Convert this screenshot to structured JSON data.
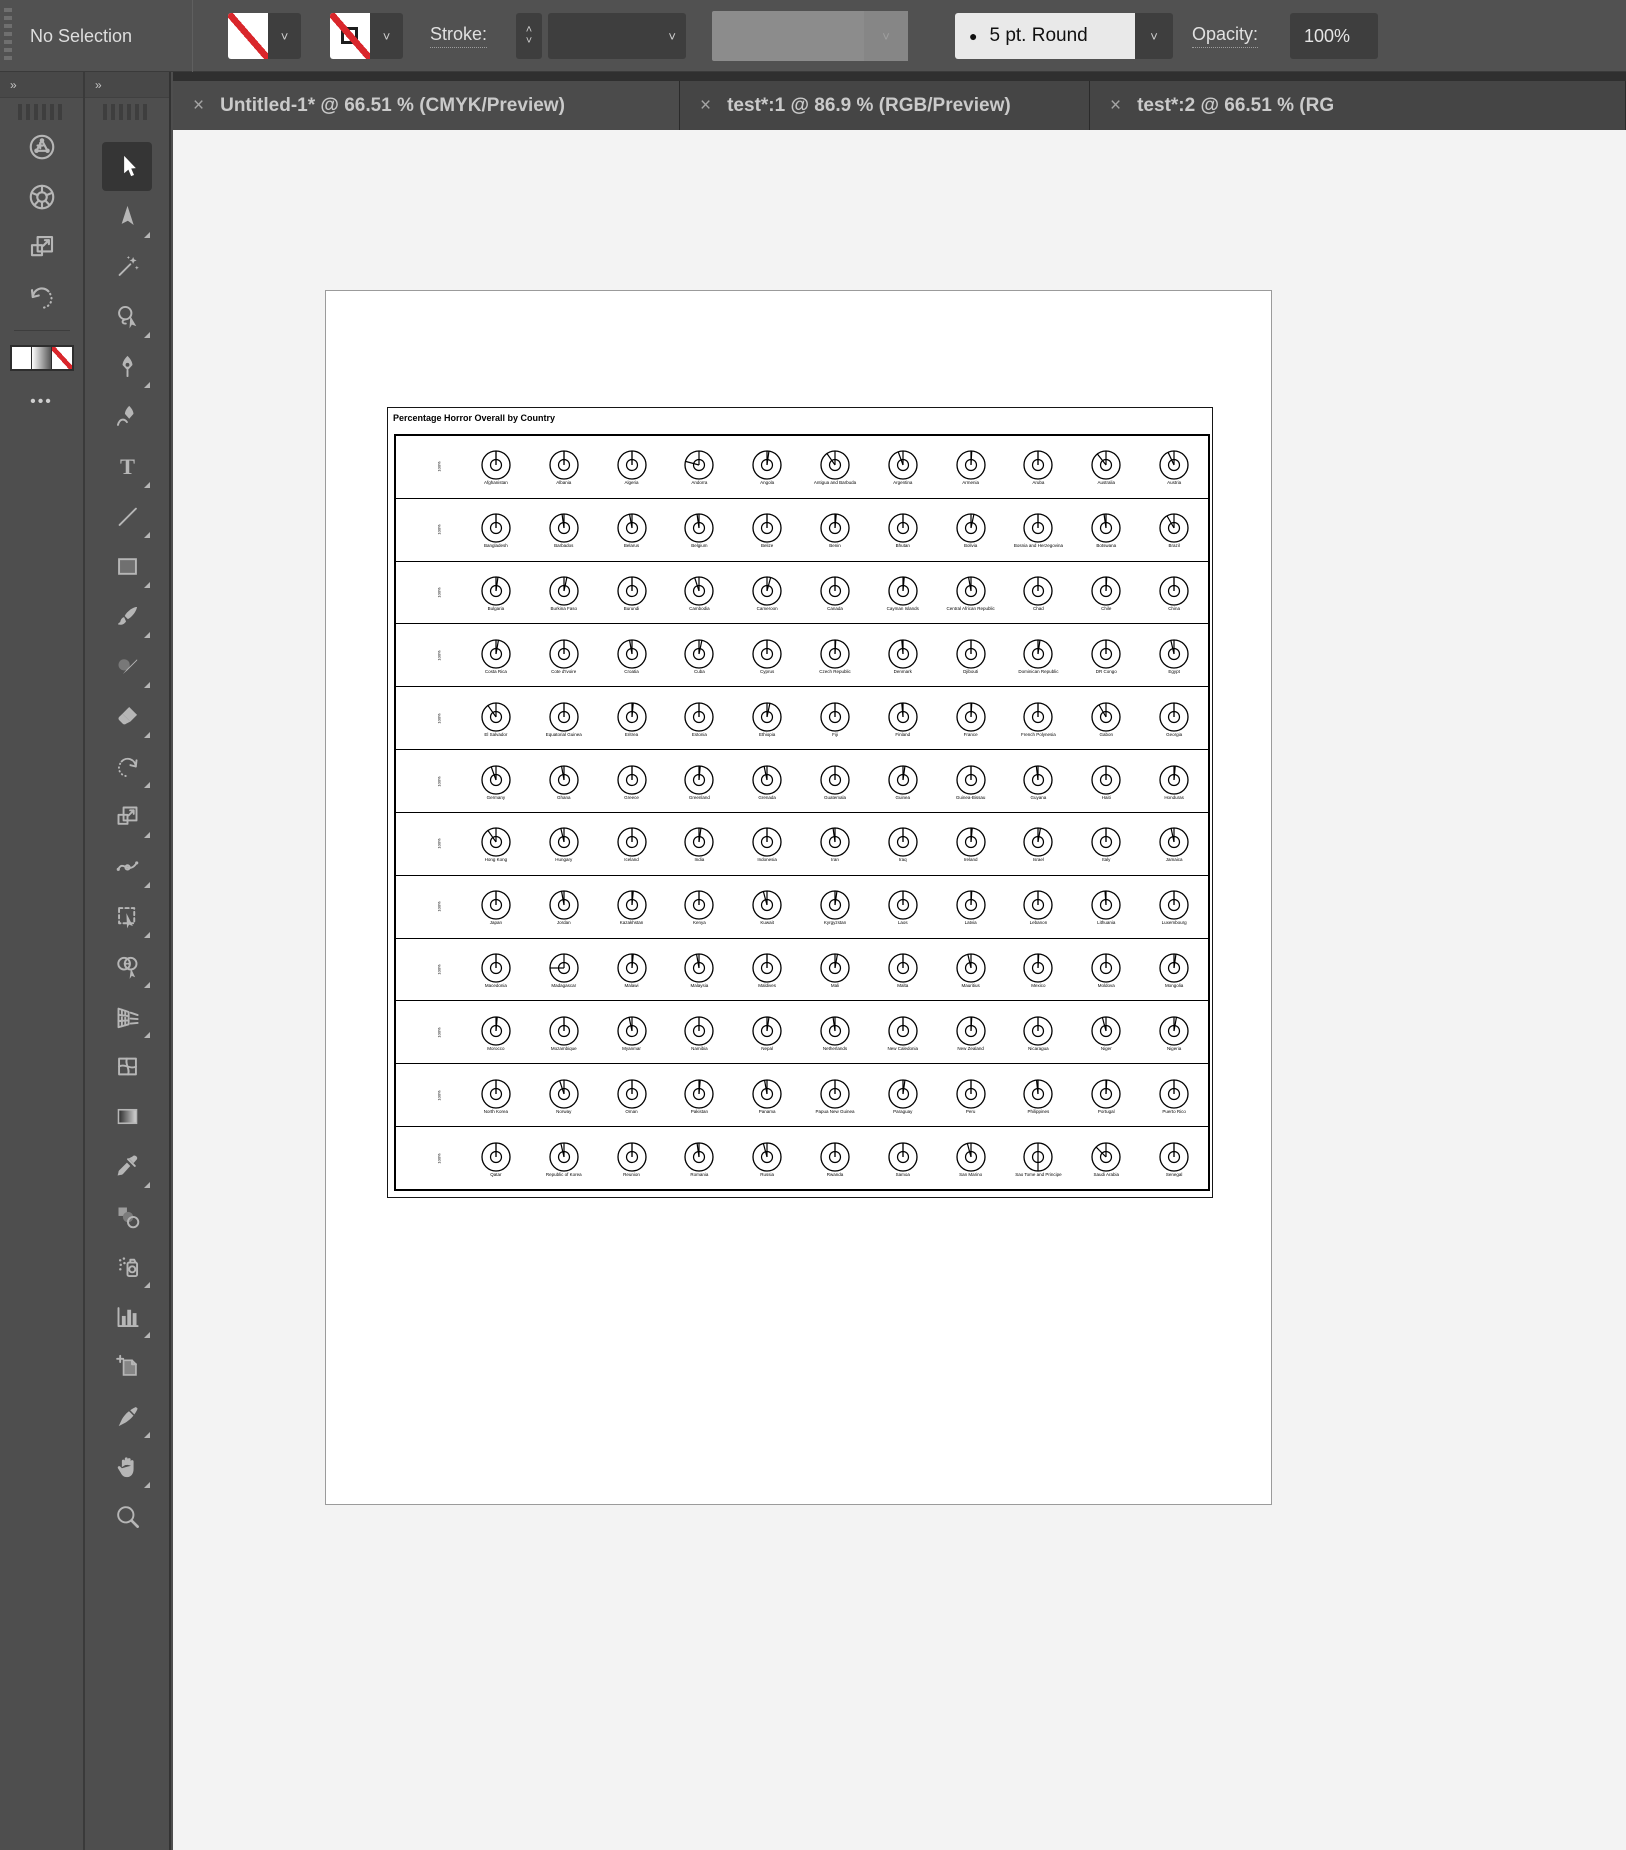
{
  "toolbar": {
    "selection_status": "No Selection",
    "stroke_label": "Stroke:",
    "stroke_width_value": "",
    "brush_bullet": "●",
    "brush_definition": "5 pt. Round",
    "opacity_label": "Opacity:",
    "opacity_value": "100%",
    "fill_swatch": "none-red-slash",
    "stroke_swatch": "none-red-slash"
  },
  "tabs": [
    {
      "close": "×",
      "label": "Untitled-1* @ 66.51 % (CMYK/Preview)"
    },
    {
      "close": "×",
      "label": "test*:1 @ 86.9 % (RGB/Preview)"
    },
    {
      "close": "×",
      "label": "test*:2 @ 66.51 % (RG"
    }
  ],
  "panel_collapse_chevron": "»",
  "dock_icons": [
    {
      "name": "touch-widget-icon"
    },
    {
      "name": "rotate-view-wheel-icon"
    },
    {
      "name": "transform-scale-icon"
    },
    {
      "name": "revert-rotate-icon"
    }
  ],
  "dock_more_label": "•••",
  "tools": [
    {
      "name": "selection",
      "active": true,
      "flyout": false
    },
    {
      "name": "direct-selection",
      "active": false,
      "flyout": true
    },
    {
      "name": "magic-wand",
      "active": false,
      "flyout": false
    },
    {
      "name": "lasso",
      "active": false,
      "flyout": true
    },
    {
      "name": "pen",
      "active": false,
      "flyout": true
    },
    {
      "name": "curvature",
      "active": false,
      "flyout": false
    },
    {
      "name": "type",
      "active": false,
      "flyout": true
    },
    {
      "name": "line-segment",
      "active": false,
      "flyout": true
    },
    {
      "name": "rectangle",
      "active": false,
      "flyout": true
    },
    {
      "name": "paintbrush",
      "active": false,
      "flyout": true
    },
    {
      "name": "shaper",
      "active": false,
      "flyout": true
    },
    {
      "name": "eraser",
      "active": false,
      "flyout": true
    },
    {
      "name": "rotate",
      "active": false,
      "flyout": true
    },
    {
      "name": "scale",
      "active": false,
      "flyout": true
    },
    {
      "name": "width",
      "active": false,
      "flyout": true
    },
    {
      "name": "free-transform",
      "active": false,
      "flyout": true
    },
    {
      "name": "shape-builder",
      "active": false,
      "flyout": true
    },
    {
      "name": "perspective-grid",
      "active": false,
      "flyout": true
    },
    {
      "name": "mesh",
      "active": false,
      "flyout": false
    },
    {
      "name": "gradient",
      "active": false,
      "flyout": false
    },
    {
      "name": "eyedropper",
      "active": false,
      "flyout": true
    },
    {
      "name": "blend",
      "active": false,
      "flyout": false
    },
    {
      "name": "symbol-sprayer",
      "active": false,
      "flyout": true
    },
    {
      "name": "column-graph",
      "active": false,
      "flyout": true
    },
    {
      "name": "artboard",
      "active": false,
      "flyout": false
    },
    {
      "name": "slice",
      "active": false,
      "flyout": true
    },
    {
      "name": "hand",
      "active": false,
      "flyout": true
    },
    {
      "name": "zoom",
      "active": false,
      "flyout": false
    }
  ],
  "chart_data": {
    "type": "pie",
    "variant": "radial-gauge-grid",
    "title": "Percentage Horror Overall by Country",
    "row_axis_label": "100%",
    "layout": {
      "rows": 12,
      "cols": 11,
      "legend": "none",
      "grid": "row-bands"
    },
    "value_encoding": "needle angle, degrees clockwise from 12 o'clock (percent of 360)",
    "rows": [
      {
        "countries": [
          "Afghanistan",
          "Albania",
          "Algeria",
          "Andorra",
          "Angola",
          "Antigua and Barbuda",
          "Argentina",
          "Armenia",
          "Aruba",
          "Australia",
          "Austria"
        ],
        "angles": [
          0,
          0,
          0,
          285,
          8,
          325,
          340,
          3,
          0,
          322,
          335
        ]
      },
      {
        "countries": [
          "Bangladesh",
          "Barbados",
          "Belarus",
          "Belgium",
          "Belize",
          "Benin",
          "Bhutan",
          "Bolivia",
          "Bosnia and Herzegovina",
          "Botswana",
          "Brazil"
        ],
        "angles": [
          0,
          352,
          350,
          352,
          0,
          5,
          0,
          12,
          0,
          352,
          330
        ]
      },
      {
        "countries": [
          "Bulgaria",
          "Burkina Faso",
          "Burundi",
          "Cambodia",
          "Cameroon",
          "Canada",
          "Cayman Islands",
          "Central African Republic",
          "Chad",
          "Chile",
          "China"
        ],
        "angles": [
          8,
          12,
          0,
          342,
          15,
          0,
          5,
          350,
          0,
          3,
          0
        ]
      },
      {
        "countries": [
          "Costa Rica",
          "Cote d'Ivoire",
          "Croatia",
          "Cuba",
          "Cyprus",
          "Czech Republic",
          "Denmark",
          "Djibouti",
          "Dominican Republic",
          "DR Congo",
          "Egypt"
        ],
        "angles": [
          10,
          0,
          350,
          12,
          0,
          3,
          355,
          0,
          8,
          0,
          347
        ]
      },
      {
        "countries": [
          "El Salvador",
          "Equatorial Guinea",
          "Eritrea",
          "Estonia",
          "Ethiopia",
          "Fiji",
          "Finland",
          "France",
          "French Polynesia",
          "Gabon",
          "Georgia"
        ],
        "angles": [
          325,
          0,
          5,
          0,
          12,
          0,
          355,
          3,
          0,
          330,
          0
        ]
      },
      {
        "countries": [
          "Germany",
          "Ghana",
          "Greece",
          "Greenland",
          "Grenada",
          "Guatemala",
          "Guinea",
          "Guinea-Bissau",
          "Guyana",
          "Haiti",
          "Honduras"
        ],
        "angles": [
          340,
          350,
          0,
          5,
          348,
          0,
          8,
          0,
          353,
          0,
          5
        ]
      },
      {
        "countries": [
          "Hong Kong",
          "Hungary",
          "Iceland",
          "India",
          "Indonesia",
          "Iran",
          "Iraq",
          "Ireland",
          "Israel",
          "Italy",
          "Jamaica"
        ],
        "angles": [
          325,
          347,
          0,
          8,
          0,
          352,
          0,
          5,
          10,
          0,
          348
        ]
      },
      {
        "countries": [
          "Japan",
          "Jordan",
          "Kazakhstan",
          "Kenya",
          "Kuwait",
          "Kyrgyzstan",
          "Laos",
          "Latvia",
          "Lebanon",
          "Lithuania",
          "Luxembourg"
        ],
        "angles": [
          0,
          350,
          5,
          0,
          345,
          8,
          0,
          3,
          0,
          356,
          0
        ]
      },
      {
        "countries": [
          "Macedonia",
          "Madagascar",
          "Malawi",
          "Malaysia",
          "Maldives",
          "Mali",
          "Malta",
          "Mauritius",
          "Mexico",
          "Moldova",
          "Mongolia"
        ],
        "angles": [
          0,
          270,
          5,
          350,
          0,
          10,
          0,
          347,
          3,
          0,
          8
        ]
      },
      {
        "countries": [
          "Morocco",
          "Mozambique",
          "Myanmar",
          "Namibia",
          "Nepal",
          "Netherlands",
          "New Caledonia",
          "New Zealand",
          "Nicaragua",
          "Niger",
          "Nigeria"
        ],
        "angles": [
          5,
          0,
          348,
          0,
          8,
          352,
          0,
          3,
          0,
          345,
          10
        ]
      },
      {
        "countries": [
          "North Korea",
          "Norway",
          "Oman",
          "Pakistan",
          "Panama",
          "Papua New Guinea",
          "Paraguay",
          "Peru",
          "Philippines",
          "Portugal",
          "Puerto Rico"
        ],
        "angles": [
          0,
          342,
          0,
          5,
          350,
          0,
          8,
          0,
          354,
          3,
          0
        ]
      },
      {
        "countries": [
          "Qatar",
          "Republic of Korea",
          "Reunion",
          "Romania",
          "Russia",
          "Rwanda",
          "Samoa",
          "San Marino",
          "Sao Tome and Principe",
          "Saudi Arabia",
          "Senegal"
        ],
        "angles": [
          0,
          347,
          0,
          352,
          345,
          0,
          0,
          345,
          180,
          315,
          0
        ]
      }
    ]
  }
}
